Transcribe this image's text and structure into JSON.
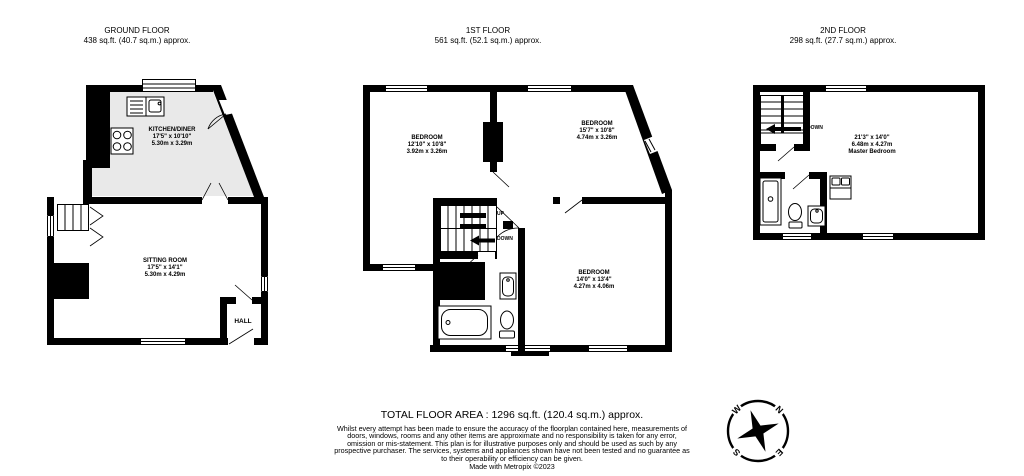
{
  "colors": {
    "wall_color": "#000000",
    "kitchen_floor_color": "#e9e9e9"
  },
  "floors": {
    "ground": {
      "title": "GROUND FLOOR",
      "area_label": "438 sq.ft. (40.7 sq.m.) approx.",
      "rooms": {
        "kitchen_diner": {
          "name": "KITCHEN/DINER",
          "dims_imperial": "17'5\" x 10'10\"",
          "dims_metric": "5.30m x 3.29m"
        },
        "sitting_room": {
          "name": "SITTING ROOM",
          "dims_imperial": "17'5\" x 14'1\"",
          "dims_metric": "5.30m x 4.29m"
        },
        "hall": {
          "name": "HALL"
        }
      }
    },
    "first": {
      "title": "1ST FLOOR",
      "area_label": "561 sq.ft. (52.1 sq.m.) approx.",
      "rooms": {
        "bedroom_front": {
          "name": "BEDROOM",
          "dims_imperial": "12'10\" x 10'8\"",
          "dims_metric": "3.92m x 3.26m"
        },
        "bedroom_middle": {
          "name": "BEDROOM",
          "dims_imperial": "15'7\" x 10'8\"",
          "dims_metric": "4.74m x 3.26m"
        },
        "bedroom_rear": {
          "name": "BEDROOM",
          "dims_imperial": "14'0\" x 13'4\"",
          "dims_metric": "4.27m x 4.06m"
        }
      },
      "stair_labels": {
        "up": "UP",
        "down": "DOWN"
      }
    },
    "second": {
      "title": "2ND FLOOR",
      "area_label": "298 sq.ft. (27.7 sq.m.) approx.",
      "rooms": {
        "master_bedroom": {
          "dims_imperial": "21'3\" x 14'0\"",
          "dims_metric": "6.48m x 4.27m",
          "name": "Master Bedroom"
        }
      },
      "stair_labels": {
        "down": "DOWN"
      }
    }
  },
  "compass": {
    "north": "N",
    "east": "E",
    "south": "S",
    "west": "W"
  },
  "footer": {
    "total_area": "TOTAL FLOOR AREA : 1296 sq.ft. (120.4 sq.m.) approx.",
    "disclaimer": "Whilst every attempt has been made to ensure the accuracy of the floorplan contained here, measurements of doors, windows, rooms and any other items are approximate and no responsibility is taken for any error, omission or mis-statement. This plan is for illustrative purposes only and should be used as such by any prospective purchaser. The services, systems and appliances shown have not been tested and no guarantee as to their operability or efficiency can be given.",
    "credit": "Made with Metropix ©2023"
  }
}
